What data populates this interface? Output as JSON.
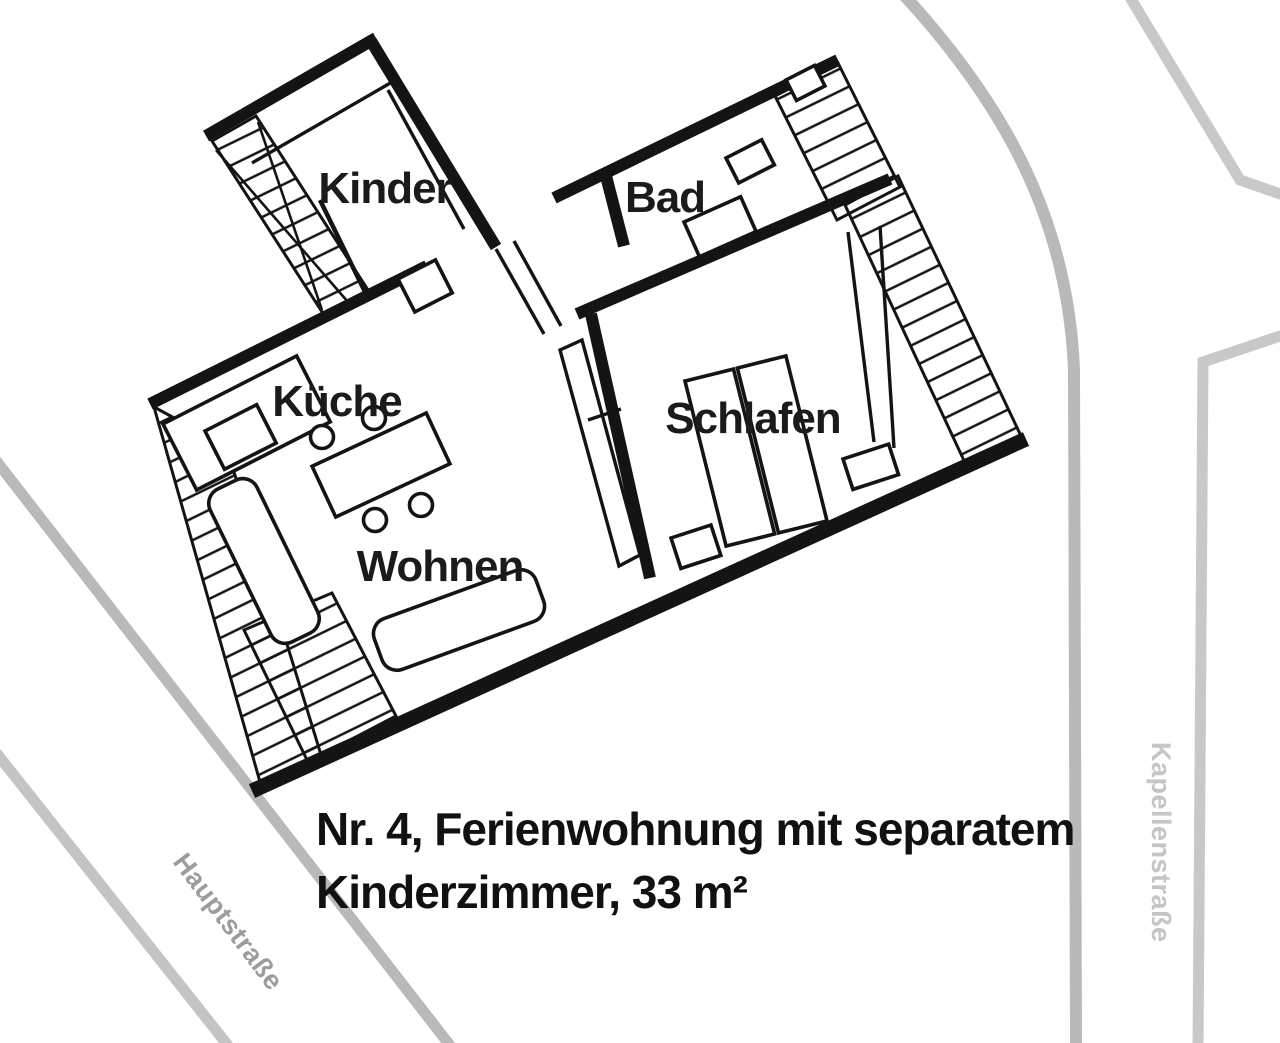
{
  "document": {
    "kind": "apartment floor plan with site streets",
    "language": "de"
  },
  "caption": {
    "line1": "Nr. 4, Ferienwohnung mit separatem",
    "line2": "Kinderzimmer, 33 m²"
  },
  "rooms": [
    {
      "id": "kinder",
      "label": "Kinder"
    },
    {
      "id": "bad",
      "label": "Bad"
    },
    {
      "id": "kueche",
      "label": "Küche"
    },
    {
      "id": "schlafen",
      "label": "Schlafen"
    },
    {
      "id": "wohnen",
      "label": "Wohnen"
    }
  ],
  "streets": [
    {
      "id": "hauptstrasse",
      "label": "Hauptstraße"
    },
    {
      "id": "kapellenstrasse",
      "label": "Kapellenstraße"
    }
  ],
  "features": [
    "terrace-decking",
    "children-room-stairs",
    "outdoor-stairs-upper",
    "outdoor-stairs-lower",
    "kitchen-counter",
    "kitchen-sink",
    "dining-table",
    "chairs",
    "sofa",
    "bench",
    "double-bed",
    "nightstands",
    "toilet",
    "washbasin",
    "door-swing",
    "wardrobe-strip"
  ],
  "colors": {
    "wall": "#141414",
    "street_line": "#b9b9b9",
    "street_line_light": "#c8c8c8",
    "street_label": "#9c9c9c",
    "street_label_light": "#c5c5c5",
    "label_text": "#1b1b1b",
    "background": "#ffffff"
  }
}
